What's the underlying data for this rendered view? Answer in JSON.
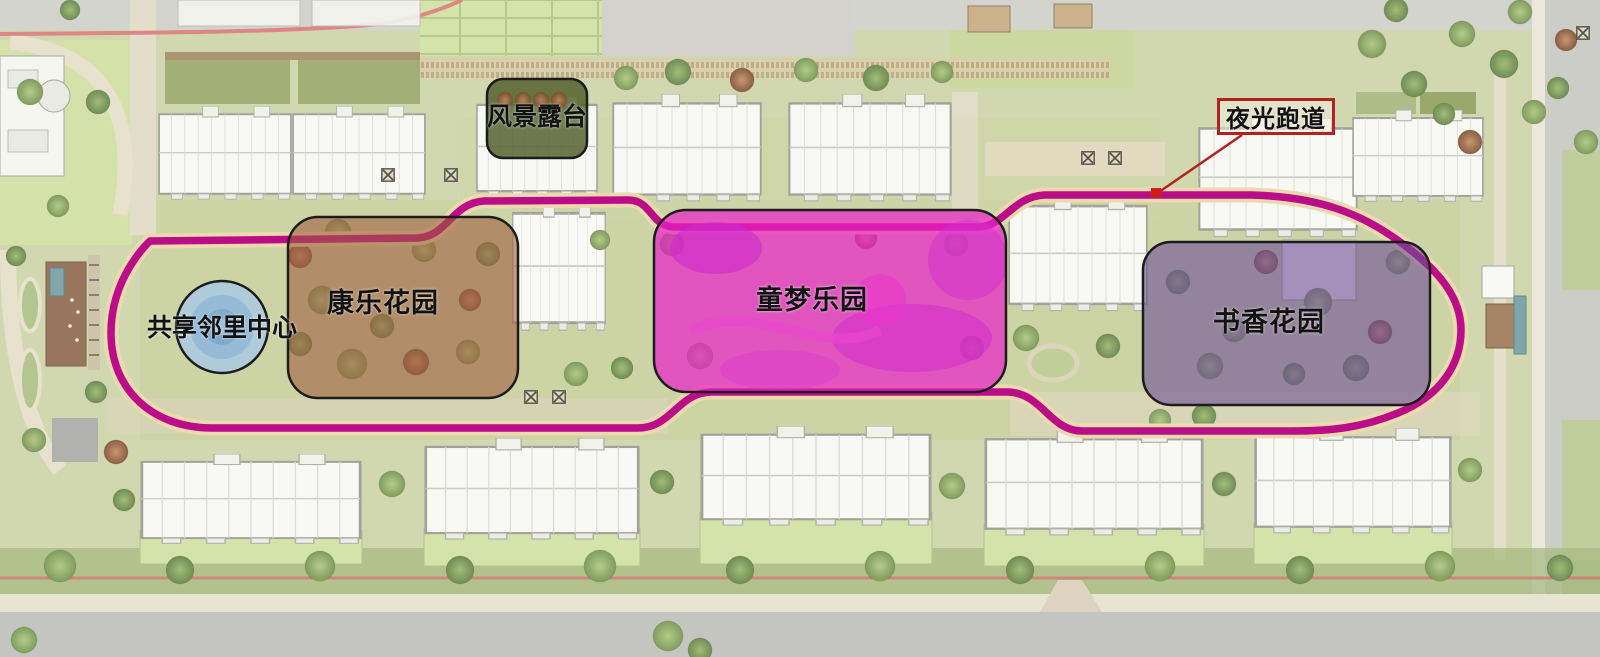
{
  "plan": {
    "zones": [
      {
        "id": "scenic-terrace",
        "label": "风景露台",
        "fill": "#55632e"
      },
      {
        "id": "shared-neighborhood-center",
        "label": "共享邻里中心",
        "fill": "#a9c9e2"
      },
      {
        "id": "recreation-garden",
        "label": "康乐花园",
        "fill": "#9c5c3c"
      },
      {
        "id": "children-dream-park",
        "label": "童梦乐园",
        "fill": "#e822c6"
      },
      {
        "id": "scholar-garden",
        "label": "书香花园",
        "fill": "#6d4d94"
      }
    ],
    "callout": {
      "id": "luminous-track",
      "label": "夜光跑道",
      "border_color": "#b3221e"
    },
    "track": {
      "color": "#bb0d87",
      "inner_path_color": "#ecd9ae"
    }
  }
}
